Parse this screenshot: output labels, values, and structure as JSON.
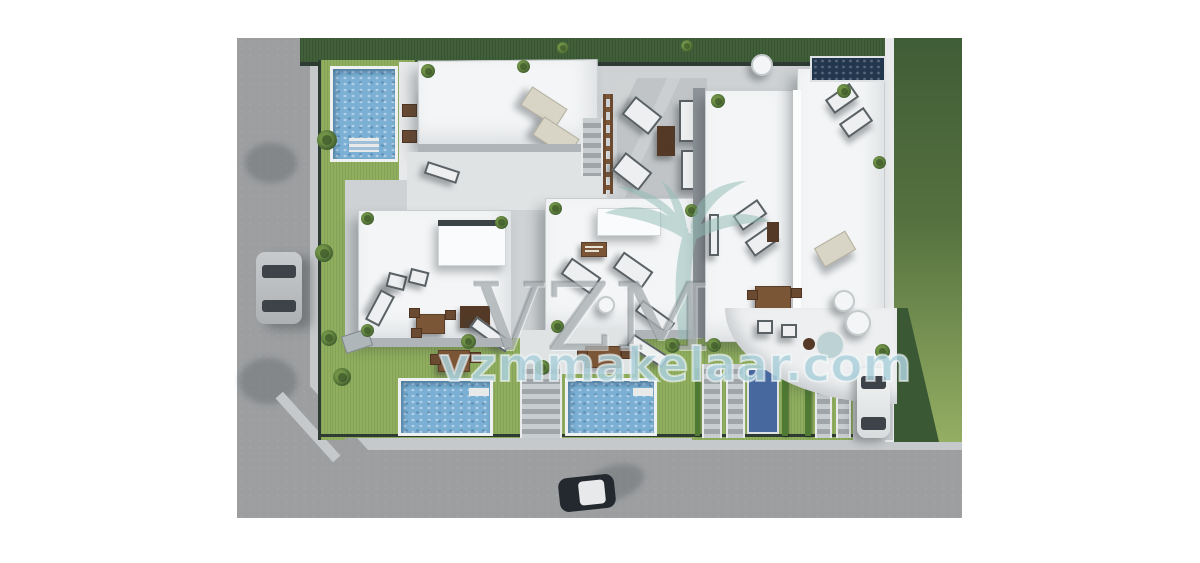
{
  "watermark": {
    "initials": "VZM",
    "website": "vzmmakelaar.com",
    "logo": "palm-tree"
  },
  "colors": {
    "road": "#9c9ea0",
    "sidewalk": "#c6c9cb",
    "paving": "#ced2d4",
    "lawn-light": "#8fae5e",
    "lawn-dark": "#41603a",
    "hedge": "#4e7a33",
    "roof-white": "#f3f5f6",
    "terrace": "#e7e9eb",
    "pool-water": "#7bb0d4",
    "pool-dark": "#22364e",
    "pool-rim": "#eef0f1",
    "wood": "#7a5636",
    "car-silver": "#b9bcbe",
    "car-dark": "#23292f",
    "car-white": "#e9ebec",
    "watermark-teal": "#93bdb6"
  },
  "scene": {
    "type": "aerial-3d-architectural-render",
    "subject": "Top-down 3D render of a modern villa development with white flat-roof houses, rooftop terraces with furniture, five swimming pools, garden lawns, perimeter streets and three parked cars",
    "buildings": [
      "top villa with roof terrace and sun loungers",
      "middle-left villa with pergola and dining set",
      "middle-center villa with pergola and loungers",
      "right duplex building with two roof terraces and curved patio"
    ],
    "pools": [
      "top-left rectangular pool",
      "top-right dark infinity pool",
      "bottom-left garden pool",
      "bottom-center garden pool",
      "bottom-right narrow plunge pool"
    ],
    "vehicles": [
      "silver car parked on left street",
      "dark car with white roof on bottom street",
      "white car parked in right driveway"
    ]
  }
}
